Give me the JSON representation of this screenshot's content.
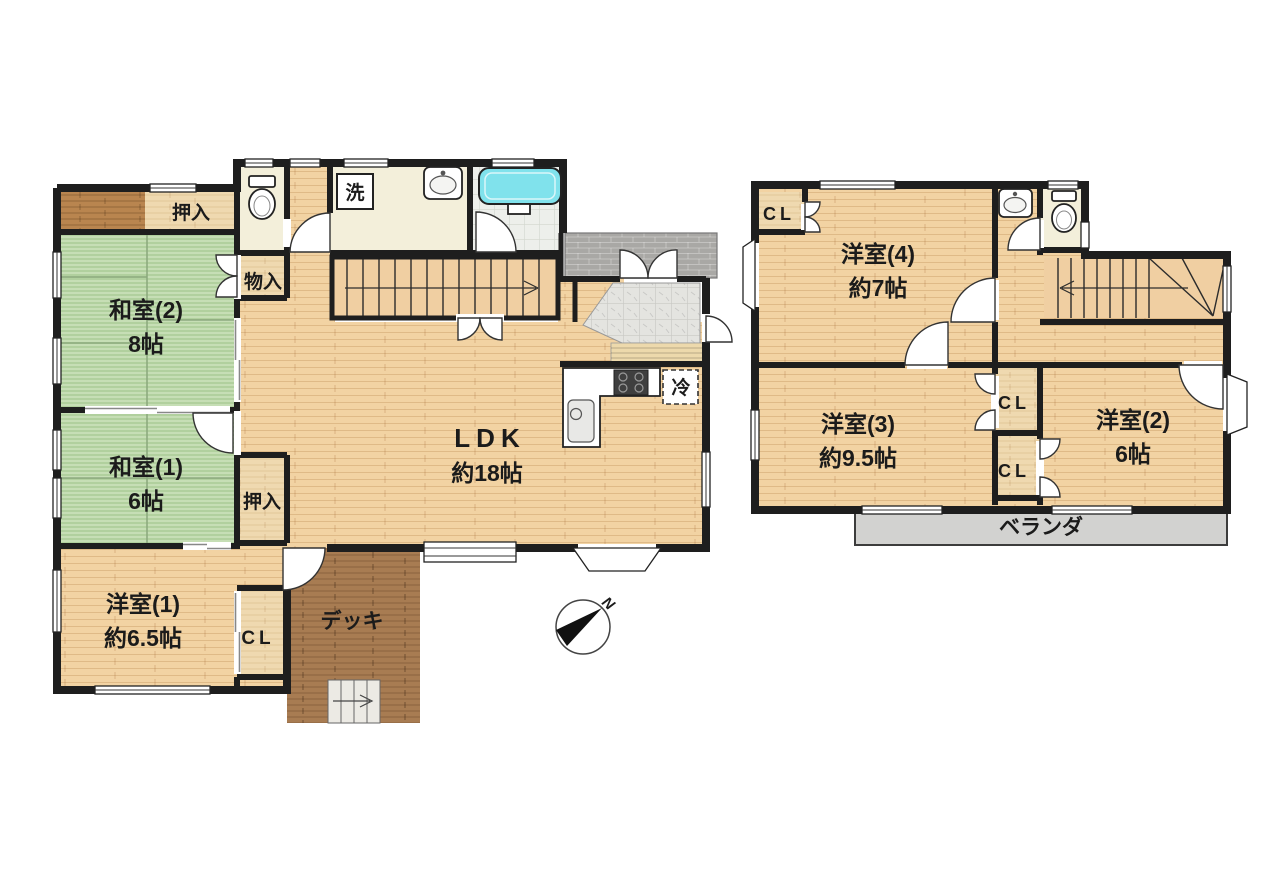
{
  "colors": {
    "wall": "#1e1e1e",
    "wood": "#f2d3a3",
    "tatami": "#b9d7a5",
    "closet": "#efd9b0",
    "dark_wood": "#b9854f",
    "deck": "#a87c52",
    "cream": "#f3efda",
    "bath_tile": "#edefeb",
    "tub": "#80e2ec",
    "genkan_tile": "#e4e4e0",
    "porch": "#a9a8a5",
    "veranda": "#d2d2d0",
    "stair": "#f0cfa2",
    "text": "#1b1b1b"
  },
  "floor1": {
    "oshiire_top": "押入",
    "washitsu2": {
      "name": "和室(2)",
      "size": "8帖"
    },
    "monoire": "物入",
    "washitsu1": {
      "name": "和室(1)",
      "size": "6帖"
    },
    "oshiire_mid": "押入",
    "youshitsu1": {
      "name": "洋室(1)",
      "size": "約6.5帖"
    },
    "closet": "CL",
    "deck": "デッキ",
    "ldk": {
      "name": "LDK",
      "size": "約18帖"
    },
    "laundry": "洗",
    "fridge": "冷"
  },
  "floor2": {
    "closet_top": "CL",
    "youshitsu4": {
      "name": "洋室(4)",
      "size": "約7帖"
    },
    "youshitsu3": {
      "name": "洋室(3)",
      "size": "約9.5帖"
    },
    "youshitsu2": {
      "name": "洋室(2)",
      "size": "6帖"
    },
    "closet_mid_upper": "CL",
    "closet_mid_lower": "CL",
    "veranda": "ベランダ"
  },
  "compass": {
    "north": "N"
  }
}
